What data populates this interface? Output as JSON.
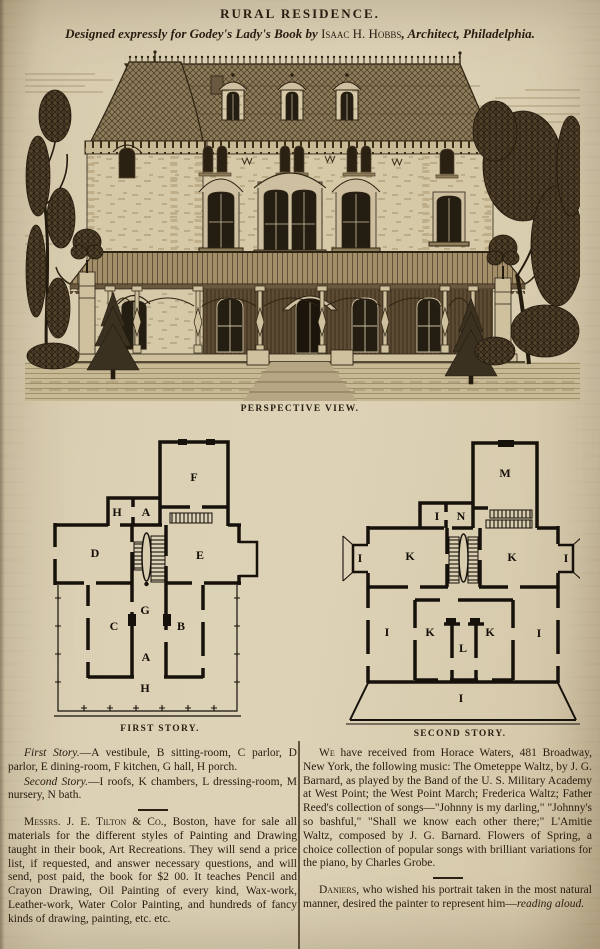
{
  "masthead": {
    "title": "RURAL RESIDENCE.",
    "subtitle_pre": "Designed expressly for Godey's Lady's Book by ",
    "subtitle_name": "Isaac H. Hobbs",
    "subtitle_post": ", Architect, Philadelphia."
  },
  "captions": {
    "perspective": "PERSPECTIVE VIEW.",
    "first_story": "FIRST STORY.",
    "second_story": "SECOND STORY."
  },
  "plans": {
    "first_story": {
      "labels": [
        "F",
        "H",
        "A",
        "D",
        "E",
        "G",
        "C",
        "B",
        "A",
        "H"
      ]
    },
    "second_story": {
      "labels": [
        "M",
        "I",
        "N",
        "K",
        "K",
        "I",
        "I",
        "I",
        "K",
        "K",
        "L",
        "I",
        "I"
      ]
    }
  },
  "columns": {
    "left": {
      "legend": [
        {
          "lead": "First Story.",
          "rest": "—A vestibule, B sitting-room, C parlor, D parlor, E dining-room, F kitchen, G hall, H porch."
        },
        {
          "lead": "Second Story.",
          "rest": "—I roofs, K chambers, L dressing-room, M nursery, N bath."
        }
      ],
      "paragraph": {
        "lead": "Messrs. J. E. Tilton & Co.",
        "rest": ", Boston, have for sale all materials for the different styles of Painting and Drawing taught in their book, Art Recreations.  They will send a price list, if requested, and answer necessary questions, and will send, post paid, the book for $2 00. It teaches Pencil and Crayon Drawing, Oil Painting of every kind, Wax-work, Leather-work, Water Color Painting, and hundreds of fancy kinds of drawing, painting, etc. etc."
      }
    },
    "right": {
      "paragraph1": {
        "lead": "We",
        "rest": " have received from Horace Waters, 481 Broadway, New York, the following music: The Ometeppe Waltz, by J. G. Barnard, as played by the Band of the U. S. Military Academy at West Point; the West Point March; Frederica Waltz; Father Reed's collection of songs—\"Johnny is my darling,\" \"Johnny's so bashful,\" \"Shall we know each other there;\" L'Amitie Waltz, composed by J. G. Barnard.  Flowers of Spring, a choice collection of popular songs with brilliant variations for the piano, by Charles Grobe."
      },
      "paragraph2": {
        "lead": "Daniers",
        "rest": ", who wished his portrait taken in the most natural manner, desired the painter to represent him—",
        "italic_end": "reading aloud."
      }
    }
  },
  "colors": {
    "paper": "#dcd1b5",
    "ink": "#281d10",
    "engraving_shadow": "#5d4c34"
  }
}
